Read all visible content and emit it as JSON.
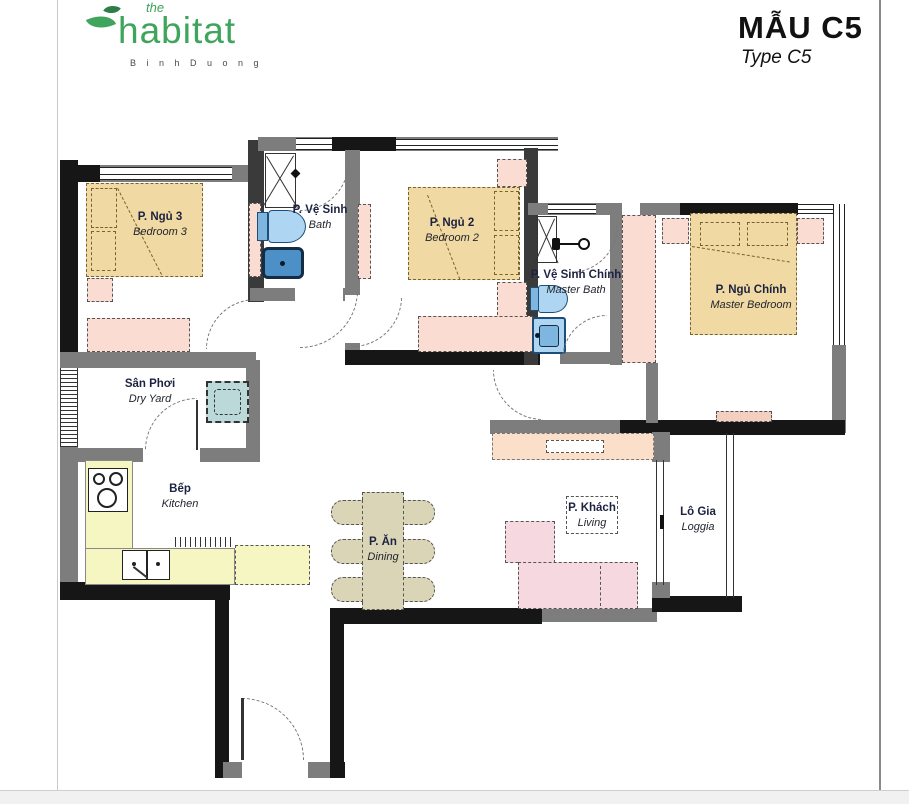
{
  "header": {
    "logo": {
      "the": "the",
      "name": "habitat",
      "location": "B i n h   D u o n g"
    },
    "title": "MẪU C5",
    "subtitle": "Type C5"
  },
  "rooms": {
    "bedroom3": {
      "vi": "P. Ngủ 3",
      "en": "Bedroom 3"
    },
    "bath": {
      "vi": "P. Vệ Sinh",
      "en": "Bath"
    },
    "bedroom2": {
      "vi": "P. Ngủ 2",
      "en": "Bedroom 2"
    },
    "master_bath": {
      "vi": "P. Vệ Sinh Chính",
      "en": "Master Bath"
    },
    "master_bedroom": {
      "vi": "P. Ngủ Chính",
      "en": "Master Bedroom"
    },
    "dry_yard": {
      "vi": "Sân Phơi",
      "en": "Dry Yard"
    },
    "kitchen": {
      "vi": "Bếp",
      "en": "Kitchen"
    },
    "dining": {
      "vi": "P. Ăn",
      "en": "Dining"
    },
    "living": {
      "vi": "P. Khách",
      "en": "Living"
    },
    "loggia": {
      "vi": "Lô Gia",
      "en": "Loggia"
    }
  },
  "colors": {
    "logo_green": "#3fa45c",
    "bed_tan": "#f0d9a2",
    "furniture_pink": "#fbdcd2",
    "sofa_pink": "#f6d9e0",
    "console_peach": "#fcdfc8",
    "counter_yellow": "#f6f6c3",
    "washer_teal": "#bcd9da",
    "fixture_blue": "#aed6f2",
    "dining_khaki": "#d9d5b6",
    "wall_dark": "#161616",
    "wall_gray": "#7d7d7d",
    "label_navy": "#1c2240"
  }
}
